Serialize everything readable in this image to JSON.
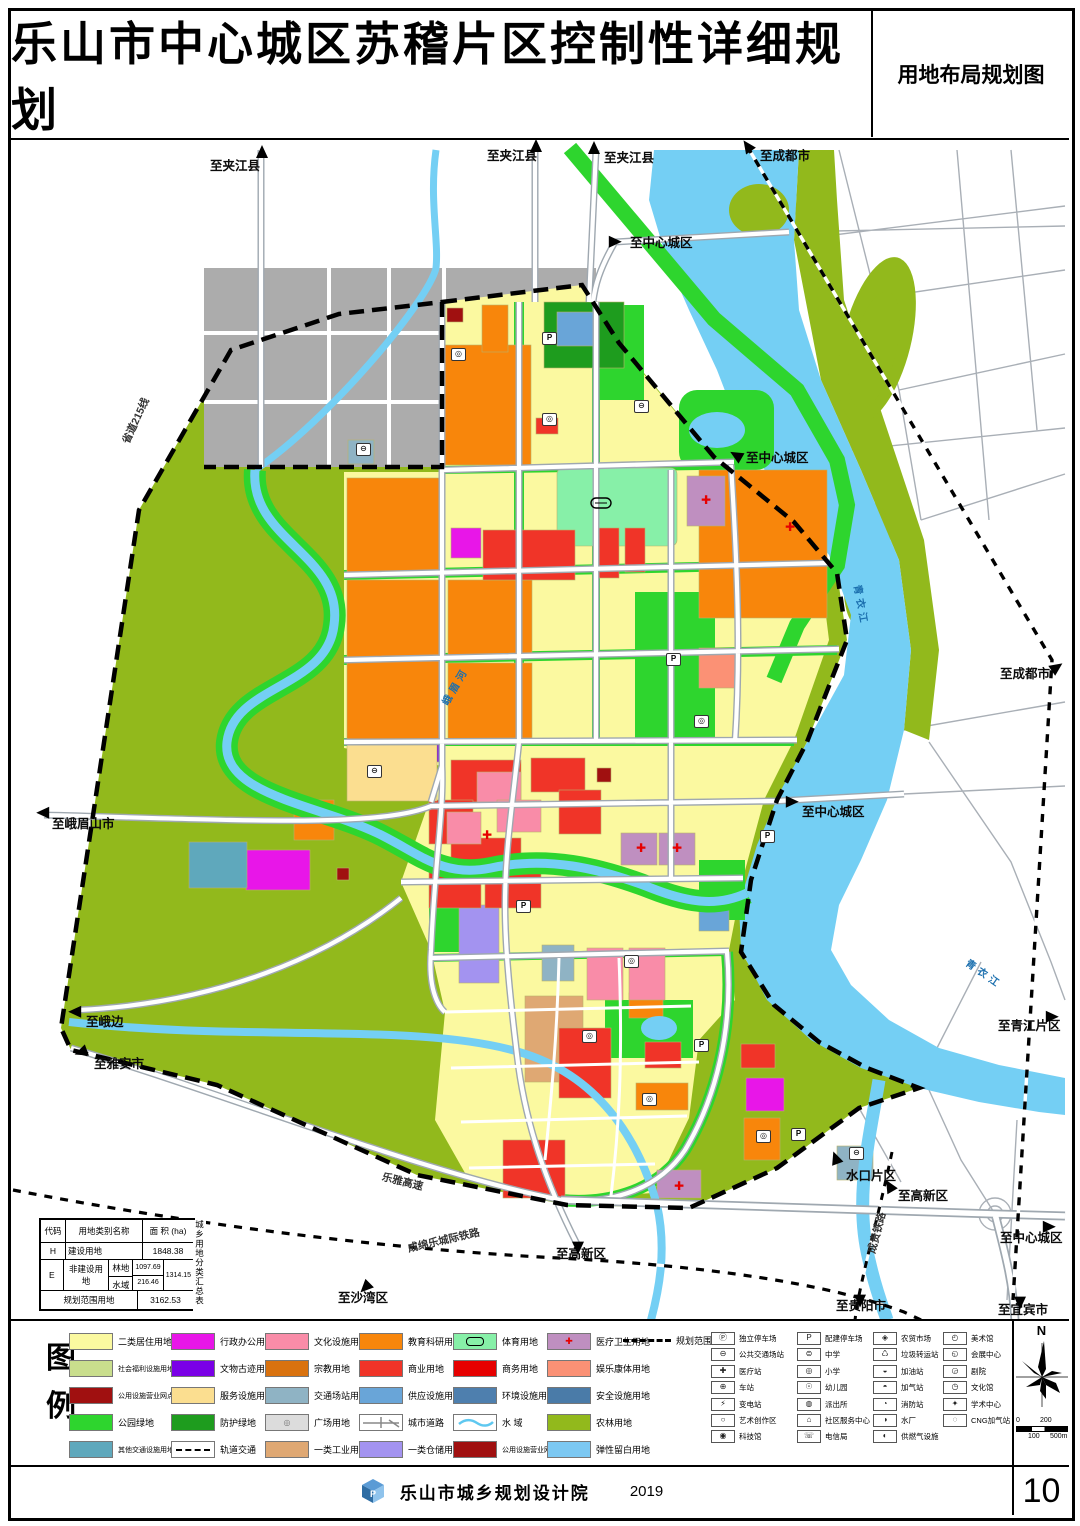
{
  "header": {
    "title": "乐山市中心城区苏稽片区控制性详细规划",
    "map_type": "用地布局规划图"
  },
  "footer": {
    "org": "乐山市城乡规划设计院",
    "year": "2019",
    "page": "10"
  },
  "compass": {
    "north": "N"
  },
  "scalebar": {
    "labels": [
      "0",
      "100",
      "200",
      "500m"
    ]
  },
  "map": {
    "labels": [
      {
        "t": "至夹江县",
        "x": 210,
        "y": 160,
        "c": "dir"
      },
      {
        "t": "至夹江县",
        "x": 487,
        "y": 150,
        "c": "dir"
      },
      {
        "t": "至夹江县",
        "x": 604,
        "y": 152,
        "c": "dir"
      },
      {
        "t": "至成都市",
        "x": 760,
        "y": 150,
        "c": "dir"
      },
      {
        "t": "至中心城区",
        "x": 630,
        "y": 237,
        "c": "dir"
      },
      {
        "t": "至中心城区",
        "x": 746,
        "y": 452,
        "c": "dir"
      },
      {
        "t": "至成都市",
        "x": 1000,
        "y": 668,
        "c": "dir"
      },
      {
        "t": "至中心城区",
        "x": 802,
        "y": 806,
        "c": "dir"
      },
      {
        "t": "至青江片区",
        "x": 998,
        "y": 1020,
        "c": "dir"
      },
      {
        "t": "至峨眉山市",
        "x": 52,
        "y": 818,
        "c": "dir"
      },
      {
        "t": "至峨边",
        "x": 86,
        "y": 1016,
        "c": "dir"
      },
      {
        "t": "至雅安市",
        "x": 94,
        "y": 1058,
        "c": "dir"
      },
      {
        "t": "至沙湾区",
        "x": 338,
        "y": 1292,
        "c": "dir"
      },
      {
        "t": "至高新区",
        "x": 556,
        "y": 1248,
        "c": "dir"
      },
      {
        "t": "水口片区",
        "x": 846,
        "y": 1170,
        "c": "dir"
      },
      {
        "t": "至高新区",
        "x": 898,
        "y": 1190,
        "c": "dir"
      },
      {
        "t": "至贵阳市",
        "x": 836,
        "y": 1300,
        "c": "dir"
      },
      {
        "t": "至中心城区",
        "x": 1000,
        "y": 1232,
        "c": "dir"
      },
      {
        "t": "至宜宾市",
        "x": 998,
        "y": 1304,
        "c": "dir"
      },
      {
        "t": "省道215线",
        "x": 126,
        "y": 438,
        "r": -65,
        "c": "road"
      },
      {
        "t": "乐雅高速",
        "x": 382,
        "y": 1172,
        "r": 14,
        "c": "road"
      },
      {
        "t": "成绵乐城际铁路",
        "x": 408,
        "y": 1244,
        "r": -13,
        "c": "road"
      },
      {
        "t": "成贵铁路",
        "x": 872,
        "y": 1248,
        "r": -75,
        "c": "road"
      },
      {
        "t": "峨眉河",
        "x": 446,
        "y": 700,
        "r": -60,
        "c": "river"
      },
      {
        "t": "青衣江",
        "x": 856,
        "y": 580,
        "r": 80,
        "c": "river"
      },
      {
        "t": "青衣江",
        "x": 966,
        "y": 958,
        "r": 35,
        "c": "river"
      }
    ],
    "arrows": [
      {
        "x": 262,
        "y": 152,
        "r": 0
      },
      {
        "x": 536,
        "y": 146,
        "r": 0
      },
      {
        "x": 594,
        "y": 148,
        "r": 0
      },
      {
        "x": 748,
        "y": 146,
        "r": -35
      },
      {
        "x": 614,
        "y": 241,
        "r": 90
      },
      {
        "x": 737,
        "y": 455,
        "r": -60
      },
      {
        "x": 1056,
        "y": 667,
        "r": 55
      },
      {
        "x": 791,
        "y": 801,
        "r": 90
      },
      {
        "x": 1051,
        "y": 1016,
        "r": 90
      },
      {
        "x": 44,
        "y": 812,
        "r": -90
      },
      {
        "x": 76,
        "y": 1011,
        "r": -90
      },
      {
        "x": 82,
        "y": 1051,
        "r": -110
      },
      {
        "x": 366,
        "y": 1286,
        "r": -135
      },
      {
        "x": 578,
        "y": 1246,
        "r": 180
      },
      {
        "x": 836,
        "y": 1158,
        "r": -20
      },
      {
        "x": 890,
        "y": 1186,
        "r": -30
      },
      {
        "x": 860,
        "y": 1299,
        "r": 180
      },
      {
        "x": 1048,
        "y": 1226,
        "r": 90
      },
      {
        "x": 1020,
        "y": 1301,
        "r": 180
      }
    ],
    "pois": [
      {
        "x": 548,
        "y": 337,
        "g": "P"
      },
      {
        "x": 672,
        "y": 658,
        "g": "P"
      },
      {
        "x": 766,
        "y": 835,
        "g": "P"
      },
      {
        "x": 522,
        "y": 905,
        "g": "P"
      },
      {
        "x": 797,
        "y": 1133,
        "g": "P"
      },
      {
        "x": 700,
        "y": 1044,
        "g": "P"
      },
      {
        "x": 373,
        "y": 770,
        "g": "⊖"
      },
      {
        "x": 362,
        "y": 448,
        "g": "⊖"
      },
      {
        "x": 457,
        "y": 353,
        "g": "◎"
      },
      {
        "x": 548,
        "y": 418,
        "g": "◎"
      },
      {
        "x": 640,
        "y": 405,
        "g": "⊖"
      },
      {
        "x": 700,
        "y": 720,
        "g": "◎"
      },
      {
        "x": 588,
        "y": 1035,
        "g": "◎"
      },
      {
        "x": 648,
        "y": 1098,
        "g": "◎"
      },
      {
        "x": 762,
        "y": 1135,
        "g": "◎"
      },
      {
        "x": 855,
        "y": 1152,
        "g": "⊖"
      },
      {
        "x": 630,
        "y": 960,
        "g": "◎"
      }
    ],
    "crosses": [
      {
        "x": 641,
        "y": 848
      },
      {
        "x": 677,
        "y": 848
      },
      {
        "x": 706,
        "y": 500
      },
      {
        "x": 790,
        "y": 527
      },
      {
        "x": 679,
        "y": 1186
      },
      {
        "x": 487,
        "y": 835
      }
    ],
    "area_table": {
      "col_code": "代码",
      "col_name": "用地类别名称",
      "col_area": "面 积 (ha)",
      "side": "城乡用地分类汇总表",
      "h_code": "H",
      "h_name": "建设用地",
      "h_area": "1848.38",
      "e_code": "E",
      "e_name": "非建设用地",
      "forest_label": "林地",
      "forest": "1097.69",
      "water_label": "水域",
      "water": "216.46",
      "e_area": "1314.15",
      "total_label": "规划范围用地",
      "total": "3162.53"
    },
    "landuse_table": {
      "side_label": "城市建设用地分类汇总表",
      "row_headers": {
        "code": "代码",
        "name": "用地类别名称",
        "area": "面积(ha)",
        "pct": "比例(%)"
      },
      "left": {
        "name": "城市建设用地",
        "area": "1846.38",
        "pct": "100"
      },
      "groups": [
        {
          "L": "",
          "cols": [
            {
              "c": "",
              "n": "弹性留白用地",
              "a": "9.19"
            }
          ],
          "s": "9.19",
          "p": "0.50"
        },
        {
          "L": "G",
          "cols": [
            {
              "c": "G3",
              "n": "广场用地",
              "a": "16.85"
            },
            {
              "c": "G2",
              "n": "防护绿地",
              "a": "19.68"
            },
            {
              "c": "G1",
              "n": "公园绿地",
              "a": "355.06"
            }
          ],
          "s": "391.59",
          "p": "21.18"
        },
        {
          "L": "U",
          "cols": [
            {
              "c": "U3",
              "n": "安全设施用地",
              "a": "1.96"
            },
            {
              "c": "U2",
              "n": "环境设施用地",
              "a": "1.07"
            },
            {
              "c": "U1",
              "n": "供应设施用地",
              "a": "10.89"
            }
          ],
          "s": "13.92",
          "p": "0.75"
        },
        {
          "L": "S",
          "cols": [
            {
              "c": "S9",
              "n": "其他交通设施用地",
              "a": "12.41"
            },
            {
              "c": "S4",
              "n": "交通场站用地",
              "a": "13.50"
            },
            {
              "c": "S1",
              "n": "城市道路用地",
              "a": "420.31"
            }
          ],
          "s": "446.22",
          "p": "24.14"
        },
        {
          "L": "W",
          "cols": [
            {
              "c": "W1",
              "n": "一类仓储用地",
              "a": "9.87"
            }
          ],
          "s": "9.87",
          "p": "0.53"
        },
        {
          "L": "W",
          "cols": [
            {
              "c": "W1",
              "n": "一类工业用地",
              "a": "22.59"
            }
          ],
          "s": "22.59",
          "p": "1.22"
        },
        {
          "L": "B",
          "cols": [
            {
              "c": "B4",
              "n": "公用设施营业网点用地",
              "a": "6.77"
            },
            {
              "c": "B3",
              "n": "娱乐康体用地",
              "a": "1.71"
            },
            {
              "c": "B2",
              "n": "商务用地",
              "a": "2.68"
            },
            {
              "c": "B1",
              "n": "商业用地",
              "a": "129.73"
            }
          ],
          "s": "140.89",
          "p": "7.63"
        },
        {
          "L": "A",
          "cols": [
            {
              "c": "A9",
              "n": "宗教用地",
              "a": "1.86"
            },
            {
              "c": "A6",
              "n": "社会福利用地",
              "a": "6.56"
            },
            {
              "c": "A5",
              "n": "医疗卫生用地",
              "a": "26.78"
            },
            {
              "c": "A4",
              "n": "体育用地",
              "a": "26.12"
            },
            {
              "c": "A3",
              "n": "教育科研用地",
              "a": "284.66"
            },
            {
              "c": "A2",
              "n": "文化设施用地",
              "a": "43.92"
            },
            {
              "c": "A1",
              "n": "行政办公用地",
              "a": "22.18"
            }
          ],
          "s": "412.08",
          "p": "22.29"
        },
        {
          "L": "R",
          "cols": [
            {
              "c": "R2",
              "n": "二类居住用地",
              "a": "402.02"
            }
          ],
          "s": "402.02",
          "p": "21.76"
        }
      ]
    }
  },
  "legend": {
    "label_chars": [
      "图",
      "例"
    ],
    "columns": [
      [
        {
          "name": "二类居住用地",
          "color": "#FBF9A0"
        },
        {
          "name": "社会福利设施用地",
          "color": "#C9DE8D"
        },
        {
          "name": "公用设施营业网点用地",
          "color": "#A01010"
        },
        {
          "name": "公园绿地",
          "color": "#2ED52E"
        },
        {
          "name": "其他交通设施用地",
          "color": "#5FA8BC"
        }
      ],
      [
        {
          "name": "行政办公用地",
          "color": "#E816E8"
        },
        {
          "name": "文物古迹用地",
          "color": "#7A00E6"
        },
        {
          "name": "服务设施用地",
          "color": "#FBDE90"
        },
        {
          "name": "防护绿地",
          "color": "#1E9C1E"
        },
        {
          "name": "轨道交通",
          "color": "#FFFFFF",
          "type": "rail"
        }
      ],
      [
        {
          "name": "文化设施用地",
          "color": "#F98CA8"
        },
        {
          "name": "宗教用地",
          "color": "#D9720F"
        },
        {
          "name": "交通场站用地",
          "color": "#8FB3C4"
        },
        {
          "name": "广场用地",
          "color": "#DCDCDC",
          "glyph": "◎"
        },
        {
          "name": "一类工业用地",
          "color": "#DFA873"
        }
      ],
      [
        {
          "name": "教育科研用地",
          "color": "#F8860B"
        },
        {
          "name": "商业用地",
          "color": "#F03428"
        },
        {
          "name": "供应设施用地",
          "color": "#69A5D8"
        },
        {
          "name": "城市道路",
          "color": "#FFFFFF",
          "type": "road"
        },
        {
          "name": "一类仓储用地",
          "color": "#A393F0"
        }
      ],
      [
        {
          "name": "体育用地",
          "color": "#87F0A8",
          "type": "sport"
        },
        {
          "name": "商务用地",
          "color": "#E60000"
        },
        {
          "name": "环境设施用地",
          "color": "#4E7FAE"
        },
        {
          "name": "水  域",
          "color": "#FFFFFF",
          "type": "water"
        },
        {
          "name": "公用设施营业网点用地",
          "color": "#A01010"
        }
      ],
      [
        {
          "name": "医疗卫生用地",
          "color": "#BF8FC0",
          "type": "medical"
        },
        {
          "name": "娱乐康体用地",
          "color": "#FB9175"
        },
        {
          "name": "安全设施用地",
          "color": "#4A7BA8"
        },
        {
          "name": "农林用地",
          "color": "#92B91C"
        },
        {
          "name": "弹性留白用地",
          "color": "#7CC8F2"
        }
      ]
    ],
    "boundary_item": {
      "name": "规划范围线"
    },
    "facilities": [
      {
        "items": [
          {
            "g": "Ⓟ",
            "label": "独立停车场"
          },
          {
            "g": "⊖",
            "label": "公共交通场站"
          },
          {
            "g": "✚",
            "label": "医疗站"
          },
          {
            "g": "⊕",
            "label": "车站"
          },
          {
            "g": "⚡",
            "label": "变电站"
          },
          {
            "g": "○",
            "label": "艺术创作区"
          },
          {
            "g": "◉",
            "label": "科技馆"
          }
        ]
      },
      {
        "items": [
          {
            "g": "P",
            "label": "配建停车场"
          },
          {
            "g": "⊜",
            "label": "中学"
          },
          {
            "g": "◎",
            "label": "小学"
          },
          {
            "g": "☉",
            "label": "幼儿园"
          },
          {
            "g": "◍",
            "label": "派出所"
          },
          {
            "g": "⌂",
            "label": "社区服务中心"
          },
          {
            "g": "☏",
            "label": "电信局"
          }
        ]
      },
      {
        "items": [
          {
            "g": "◈",
            "label": "农贸市场"
          },
          {
            "g": "♺",
            "label": "垃圾转运站"
          },
          {
            "g": "◒",
            "label": "加油站"
          },
          {
            "g": "◓",
            "label": "加气站"
          },
          {
            "g": "◔",
            "label": "消防站"
          },
          {
            "g": "◑",
            "label": "水厂"
          },
          {
            "g": "◐",
            "label": "供燃气设施"
          }
        ]
      },
      {
        "items": [
          {
            "g": "◴",
            "label": "美术馆"
          },
          {
            "g": "◵",
            "label": "会展中心"
          },
          {
            "g": "◶",
            "label": "剧院"
          },
          {
            "g": "◷",
            "label": "文化馆"
          },
          {
            "g": "✦",
            "label": "学术中心"
          },
          {
            "g": "◌",
            "label": "CNG加气站"
          }
        ]
      }
    ]
  }
}
